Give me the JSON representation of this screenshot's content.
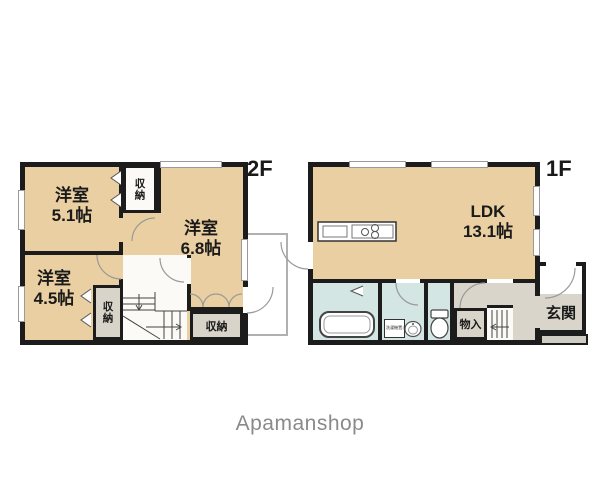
{
  "floor2": {
    "label": "2F",
    "room_51": {
      "name": "洋室",
      "size": "5.1帖"
    },
    "room_68": {
      "name": "洋室",
      "size": "6.8帖"
    },
    "room_45": {
      "name": "洋室",
      "size": "4.5帖"
    },
    "closet_upper": "収納",
    "closet_lower": "収納",
    "closet_right": "収納"
  },
  "floor1": {
    "label": "1F",
    "ldk": {
      "name": "LDK",
      "size": "13.1帖"
    },
    "storage": "物入",
    "entrance": "玄関",
    "laundry": "洗濯機置き場"
  },
  "branding": {
    "logo_text": "Apamanshop"
  },
  "colors": {
    "room_floor": "#e9cfa1",
    "wet_area": "#d3e6e4",
    "hallway": "#d9d5cb",
    "closet": "#d8d4c9",
    "wall": "#1c1c1c",
    "logo_gray": "#8a8a8a"
  }
}
